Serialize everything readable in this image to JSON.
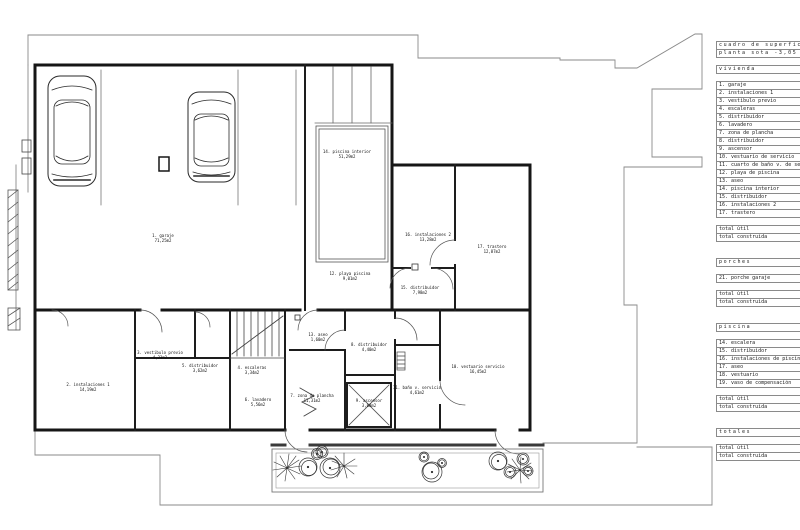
{
  "area_table": {
    "title_lines": [
      "cuadro de superficies",
      "planta sota -3,05"
    ],
    "sections": [
      {
        "header": "vivienda",
        "items": [
          "1. garaje",
          "2. instalaciones 1",
          "3. vestibulo previo",
          "4. escaleras",
          "5. distribuidor",
          "6. lavadero",
          "7. zona de plancha",
          "8. distribuidor",
          "9. ascensor",
          "10. vestuario de servicio",
          "11. cuarto de baño v. de servicio",
          "12. playa de piscina",
          "13. aseo",
          "14. piscina interior",
          "15. distribuidor",
          "16. instalaciones 2",
          "17. trastero"
        ],
        "totals": [
          "total útil",
          "total construida"
        ]
      },
      {
        "header": "porches",
        "items": [
          "21. porche garaje"
        ],
        "totals": [
          "total útil",
          "total construida"
        ]
      },
      {
        "header": "piscina",
        "items": [
          "14. escalera",
          "15. distribuidor",
          "16. instalaciones de piscina",
          "17. aseo",
          "18. vestuario",
          "19. vaso de compensación"
        ],
        "totals": [
          "total útil",
          "total construida"
        ]
      },
      {
        "header": "totales",
        "items": [],
        "totals": [
          "total útil",
          "total construida"
        ]
      }
    ]
  },
  "plan": {
    "rooms": [
      {
        "label": "1. garaje",
        "area": "71,25m2"
      },
      {
        "label": "14. piscina interior",
        "area": "51,29m2"
      },
      {
        "label": "16. instalaciones 2",
        "area": "13,28m2"
      },
      {
        "label": "17. trastero",
        "area": "12,87m2"
      },
      {
        "label": "15. distribuidor",
        "area": "7,98m2"
      },
      {
        "label": "12. playa piscina",
        "area": "9,01m2"
      },
      {
        "label": "13. aseo",
        "area": "1,60m2"
      },
      {
        "label": "8. distribuidor",
        "area": "4,40m2"
      },
      {
        "label": "2. instalaciones 1",
        "area": "14,19m2"
      },
      {
        "label": "3. vestibulo previo",
        "area": "4,23m2"
      },
      {
        "label": "5. distribuidor",
        "area": "3,62m2"
      },
      {
        "label": "4. escaleras",
        "area": "3,34m2"
      },
      {
        "label": "7. zona de plancha",
        "area": "11,31m2"
      },
      {
        "label": "9. ascensor",
        "area": "3,08m2"
      },
      {
        "label": "11. baño v. servicio",
        "area": "4,61m2"
      },
      {
        "label": "10. vestuario servicio",
        "area": "16,45m2"
      },
      {
        "label": "6. lavadero",
        "area": "5,56m2"
      }
    ]
  }
}
